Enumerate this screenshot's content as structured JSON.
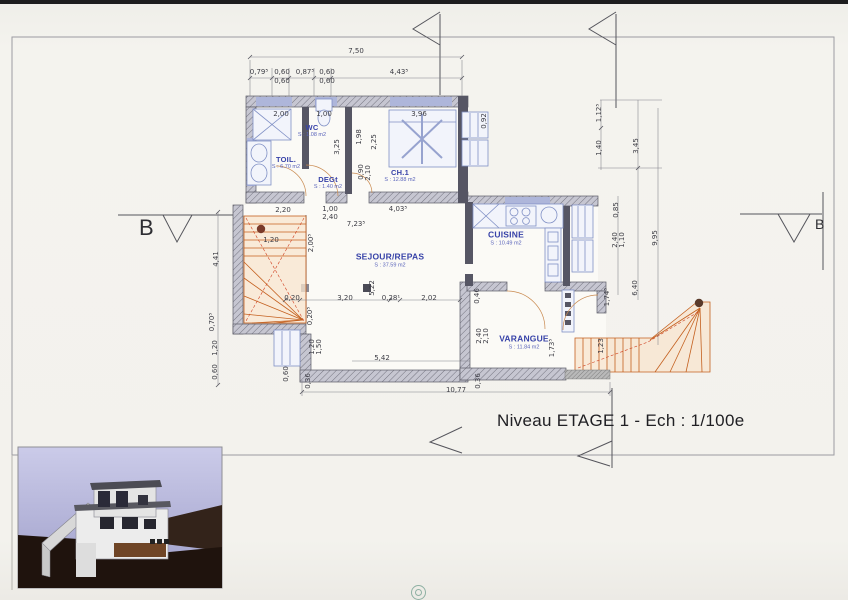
{
  "title": "Niveau ETAGE 1 - Ech : 1/100e",
  "section_labels": {
    "left": "B",
    "right": "B"
  },
  "rooms": [
    {
      "name": "WC",
      "area": "S : 1.08 m2"
    },
    {
      "name": "TOIL.",
      "area": "S : 6.70 m2"
    },
    {
      "name": "DEGt",
      "area": "S : 1.40 m2"
    },
    {
      "name": "CH.1",
      "area": "S : 12.88 m2"
    },
    {
      "name": "CUISINE",
      "area": "S : 10.49 m2"
    },
    {
      "name": "SEJOUR/REPAS",
      "area": "S : 37.59 m2"
    },
    {
      "name": "VARANGUE",
      "area": "S : 11.84 m2"
    }
  ],
  "dims": [
    "7,50",
    "0,79⁵",
    "0,60",
    "0,87⁵",
    "0,60",
    "4,43⁵",
    "0,60",
    "0,60",
    "2,00",
    "1,00",
    "3,96",
    "3,25",
    "1,98",
    "2,25",
    "0,90",
    "2,10",
    "0,92",
    "1,12⁵",
    "1,40",
    "3,45",
    "0,85",
    "2,40",
    "1,10",
    "9,95",
    "6,40",
    "2,20",
    "1,00",
    "2,40",
    "4,03⁵",
    "7,23⁵",
    "1,20",
    "2,00⁵",
    "5,22",
    "4,41",
    "0,70⁵",
    "1,20",
    "0,60",
    "0,20",
    "3,20",
    "0,28¹",
    "2,02",
    "0,20⁵",
    "1,20",
    "1,50",
    "5,42",
    "10,77",
    "0,60",
    "0,36",
    "0,36",
    "0,46",
    "2,40",
    "2,10",
    "1,73⁵",
    "1,74⁵",
    "1,23"
  ],
  "colors": {
    "wall": "#565664",
    "hatch_wall": "#c4c4cf",
    "window": "#aeb6da",
    "fixture": "#8090c5",
    "stair": "#c4601f",
    "room_label": "#3742a8",
    "dimension_text": "#3c3c44",
    "sky": "#c9c9e7",
    "terrain": "#1f130d"
  }
}
